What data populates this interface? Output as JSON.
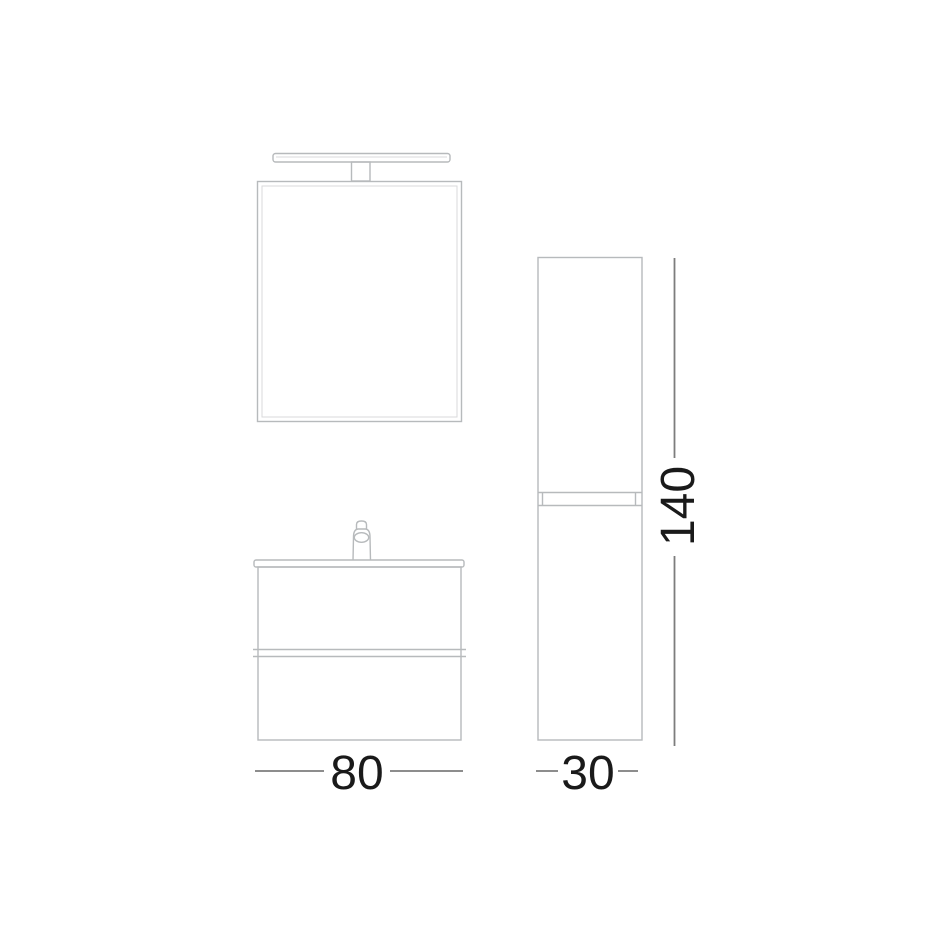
{
  "dimensions": {
    "vanity_width": "80",
    "column_width": "30",
    "column_height": "140"
  },
  "colors": {
    "background": "#ffffff",
    "outline": "#b7babc",
    "outline_light": "#d9dadb",
    "dimension_line": "#7d7d7d",
    "dimension_text": "#1a1a1a"
  }
}
